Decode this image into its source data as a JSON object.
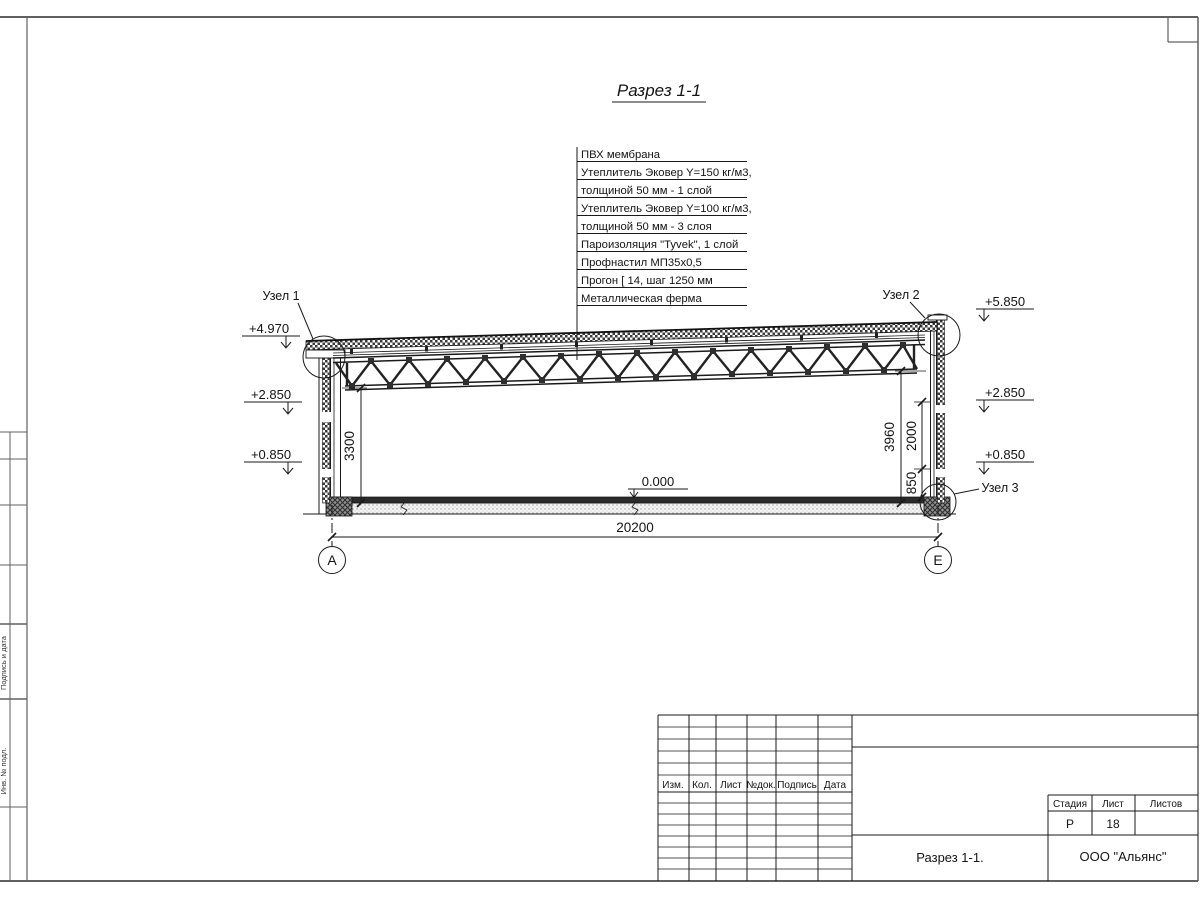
{
  "drawing_title": "Разрез 1-1",
  "layers": [
    "ПВХ мембрана",
    "Утеплитель Эковер Y=150 кг/м3,",
    "толщиной 50 мм - 1 слой",
    "Утеплитель Эковер Y=100 кг/м3,",
    "толщиной 50 мм - 3 слоя",
    "Пароизоляция \"Tyvek\", 1 слой",
    "Профнастил МП35х0,5",
    "Прогон [ 14, шаг 1250 мм",
    "Металлическая ферма"
  ],
  "nodes": {
    "n1": "Узел 1",
    "n2": "Узел 2",
    "n3": "Узел 3"
  },
  "levels": {
    "left_top": "+4.970",
    "left_mid": "+2.850",
    "left_low": "+0.850",
    "right_top": "+5.850",
    "right_mid": "+2.850",
    "right_low": "+0.850",
    "zero": "0.000"
  },
  "dims": {
    "span": "20200",
    "h_left": "3300",
    "h_right": "3960",
    "h_mid": "2000",
    "h_low": "850"
  },
  "axes": {
    "left": "А",
    "right": "Е"
  },
  "titleblock": {
    "headers": [
      "Изм.",
      "Кол.",
      "Лист",
      "№док.",
      "Подпись",
      "Дата"
    ],
    "stage_label": "Стадия",
    "sheet_label": "Лист",
    "sheets_label": "Листов",
    "stage_value": "Р",
    "sheet_value": "18",
    "sheets_value": "",
    "drawing_name": "Разрез 1-1.",
    "company": "ООО \"Альянс\""
  },
  "sidestamp": {
    "s1": "Подпись и дата",
    "s2": "Инв. № подл."
  },
  "colors": {
    "line": "#1a1a1a",
    "slab": "#2b2b2b",
    "frame": "#606060"
  }
}
